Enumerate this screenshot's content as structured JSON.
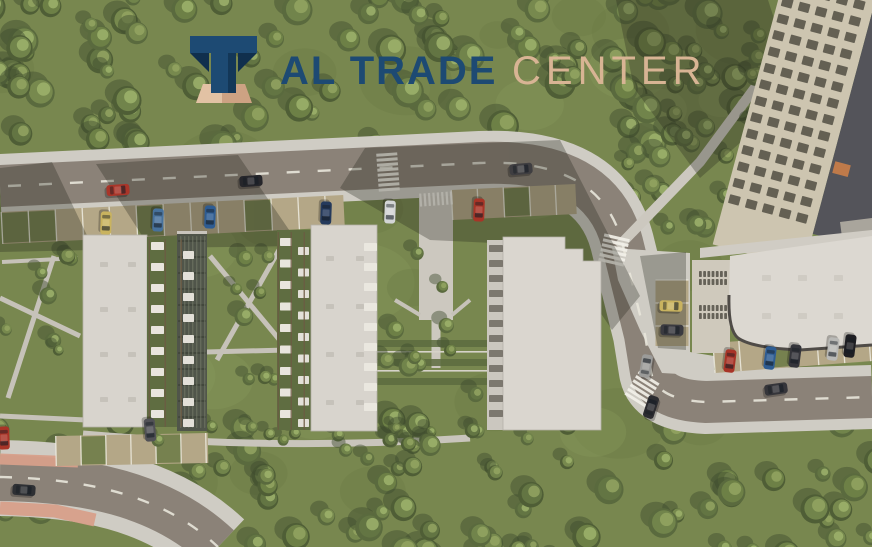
{
  "meta": {
    "width": 872,
    "height": 547,
    "kind": "aerial-masterplan-render"
  },
  "logo": {
    "icon": "arch-monument-icon",
    "title_primary": "AL TRADE",
    "title_secondary": "CENTER",
    "colors": {
      "primary": "#1d4a73",
      "primary_dark": "#102f4d",
      "secondary": "#d8b494",
      "base_light": "#e2c2a4",
      "base_mid": "#cda283"
    }
  },
  "scene": {
    "palette": {
      "grass": "#78874f",
      "grass_light": "#8a9a5c",
      "grass_dark": "#697844",
      "tree_dark": [
        "#4f5e36",
        "#5a6a3e"
      ],
      "tree_main": [
        "#6d8046",
        "#77894e",
        "#637543",
        "#71844b"
      ],
      "tree_light": [
        "#93a562",
        "#9db36c"
      ],
      "tree_shadow": "#3f4c2e",
      "road": "#8b8278",
      "sidewalk": "#cfccc4",
      "stall": "#b4a787",
      "stall_green": "#76814f",
      "stall_line": "#efede2",
      "marking": "#e8e5da",
      "crosswalk": "#f2f0e8",
      "roof": "#d8d4cd",
      "roof_big": "#dcd8d1",
      "shadow": "#23251c",
      "salmon": "#d79f8a"
    },
    "car_style": {
      "length": 23,
      "width": 11
    },
    "cars": [
      {
        "name": "car-red-main-road",
        "x": 118,
        "y": 190,
        "angle": -4,
        "color": "#a93529"
      },
      {
        "name": "car-black-main-road",
        "x": 251,
        "y": 181,
        "angle": -4,
        "color": "#26262b"
      },
      {
        "name": "car-gray-main-road",
        "x": 521,
        "y": 169,
        "angle": -5,
        "color": "#3f3e41"
      },
      {
        "name": "car-silver-east-road",
        "x": 646,
        "y": 366,
        "angle": -80,
        "color": "#9b9b99"
      },
      {
        "name": "car-dark-east-road",
        "x": 651,
        "y": 407,
        "angle": -72,
        "color": "#2c2c30"
      },
      {
        "name": "car-dark-se-road",
        "x": 776,
        "y": 389,
        "angle": -8,
        "color": "#35353a"
      },
      {
        "name": "car-dark-sw-road",
        "x": 24,
        "y": 490,
        "angle": 4,
        "color": "#2e3034"
      },
      {
        "name": "car-parked-yellow-1",
        "x": 106,
        "y": 223,
        "angle": 92,
        "color": "#c9b35f"
      },
      {
        "name": "car-parked-blue-1",
        "x": 158,
        "y": 220,
        "angle": 92,
        "color": "#47719c"
      },
      {
        "name": "car-parked-blue-2",
        "x": 210,
        "y": 217,
        "angle": 92,
        "color": "#2e5c92"
      },
      {
        "name": "car-parked-navy",
        "x": 326,
        "y": 213,
        "angle": 92,
        "color": "#253a5c"
      },
      {
        "name": "car-parked-white",
        "x": 390,
        "y": 212,
        "angle": 92,
        "color": "#d3d5d6"
      },
      {
        "name": "car-parked-red-1",
        "x": 479,
        "y": 210,
        "angle": 92,
        "color": "#a83427"
      },
      {
        "name": "car-parked-yellow-2",
        "x": 671,
        "y": 306,
        "angle": 2,
        "color": "#c9b35f"
      },
      {
        "name": "car-parked-dark-1",
        "x": 672,
        "y": 330,
        "angle": 2,
        "color": "#3a3a40"
      },
      {
        "name": "car-parked-red-2",
        "x": 730,
        "y": 361,
        "angle": 97,
        "color": "#a83427"
      },
      {
        "name": "car-parked-blue-3",
        "x": 770,
        "y": 358,
        "angle": 97,
        "color": "#2e5c92"
      },
      {
        "name": "car-parked-dark-2",
        "x": 795,
        "y": 356,
        "angle": 97,
        "color": "#35353b"
      },
      {
        "name": "car-parked-white-2",
        "x": 833,
        "y": 349,
        "angle": 97,
        "color": "#b9b9b6"
      },
      {
        "name": "car-parked-black",
        "x": 850,
        "y": 346,
        "angle": 97,
        "color": "#1f1f23"
      },
      {
        "name": "car-parked-gray-sw",
        "x": 150,
        "y": 430,
        "angle": 85,
        "color": "#515156"
      },
      {
        "name": "car-parked-red-edge",
        "x": 4,
        "y": 438,
        "angle": 88,
        "color": "#a83427"
      }
    ],
    "stall_strips": [
      {
        "name": "parking-main-west",
        "x1": 2,
        "y1": 228,
        "x2": 344,
        "y2": 211,
        "width": 32,
        "step": 27,
        "olive": [
          0,
          1,
          5,
          9
        ]
      },
      {
        "name": "parking-main-east",
        "x1": 452,
        "y1": 205,
        "x2": 576,
        "y2": 199,
        "width": 30,
        "step": 26,
        "olive": [
          2
        ]
      },
      {
        "name": "parking-se",
        "x1": 714,
        "y1": 358,
        "x2": 872,
        "y2": 346,
        "width": 30,
        "step": 26,
        "olive": [
          2
        ]
      },
      {
        "name": "parking-sw",
        "x1": 56,
        "y1": 451,
        "x2": 208,
        "y2": 448,
        "width": 30,
        "step": 25,
        "olive": [
          1,
          4
        ]
      },
      {
        "name": "parking-east-road",
        "x1": 672,
        "y1": 280,
        "x2": 672,
        "y2": 346,
        "width": 33,
        "step": 23,
        "olive": []
      }
    ],
    "crosswalks": [
      {
        "name": "crosswalk-main-road",
        "cx": 388,
        "cy": 172,
        "rotate": -4,
        "orient": "v",
        "n": 8,
        "gap": 5,
        "len": 21,
        "w": 3
      },
      {
        "name": "crosswalk-promenade",
        "cx": 436,
        "cy": 199,
        "rotate": -4,
        "orient": "h",
        "n": 8,
        "gap": 4.4,
        "len": 13,
        "w": 2.2
      },
      {
        "name": "crosswalk-east-upper",
        "cx": 614,
        "cy": 250,
        "rotate": 13,
        "orient": "v",
        "n": 6,
        "gap": 5,
        "len": 26,
        "w": 3
      },
      {
        "name": "crosswalk-east-lower",
        "cx": 642,
        "cy": 389,
        "rotate": 32,
        "orient": "v",
        "n": 6,
        "gap": 5,
        "len": 24,
        "w": 3
      }
    ],
    "vegetation": [
      {
        "name": "ambient-patches",
        "phase": 0,
        "x": 0,
        "y": 0,
        "w": 872,
        "h": 547,
        "count": 42,
        "rmin": 18,
        "rmax": 55,
        "style": "patch"
      },
      {
        "name": "north-forest",
        "phase": 1,
        "x": -10,
        "y": -12,
        "w": 892,
        "h": 158,
        "count": 100,
        "rmin": 7,
        "rmax": 16,
        "style": "tree"
      },
      {
        "name": "east-grove",
        "phase": 1,
        "x": 598,
        "y": 128,
        "w": 274,
        "h": 130,
        "count": 20,
        "rmin": 6,
        "rmax": 12,
        "style": "tree"
      },
      {
        "name": "south-forest",
        "phase": 1,
        "x": -10,
        "y": 420,
        "w": 892,
        "h": 140,
        "count": 75,
        "rmin": 7,
        "rmax": 15,
        "style": "tree"
      },
      {
        "name": "left-courtyard-trees",
        "phase": 2,
        "x": 5,
        "y": 255,
        "w": 70,
        "h": 160,
        "count": 7,
        "rmin": 5,
        "rmax": 9,
        "style": "tree"
      },
      {
        "name": "mid-courtyard-trees",
        "phase": 2,
        "x": 208,
        "y": 248,
        "w": 70,
        "h": 135,
        "count": 8,
        "rmin": 5,
        "rmax": 10,
        "style": "tree"
      },
      {
        "name": "promenade-trees",
        "phase": 2,
        "x": 382,
        "y": 222,
        "w": 100,
        "h": 175,
        "count": 10,
        "rmin": 5,
        "rmax": 10,
        "style": "tree"
      },
      {
        "name": "east-lawn-trees",
        "phase": 2,
        "x": 642,
        "y": 35,
        "w": 128,
        "h": 190,
        "count": 12,
        "rmin": 5,
        "rmax": 10,
        "style": "tree"
      },
      {
        "name": "hedgerow-trees",
        "phase": 2,
        "x": 85,
        "y": 426,
        "w": 400,
        "h": 20,
        "count": 14,
        "rmin": 5,
        "rmax": 8,
        "style": "tree"
      },
      {
        "name": "south-lawn-trees",
        "phase": 2,
        "x": 300,
        "y": 432,
        "w": 290,
        "h": 55,
        "count": 9,
        "rmin": 6,
        "rmax": 11,
        "style": "tree"
      }
    ],
    "repeats": [
      {
        "name": "tower-windows",
        "transform": "rotate(15 800 100)",
        "x": 757,
        "y": -12,
        "nx": 5,
        "ny": 14,
        "dx": 17.5,
        "dy": 17,
        "w": 11,
        "h": 9,
        "fill": "#4a463c",
        "opacity": 0.8
      },
      {
        "name": "garage-wing-louvers-1",
        "x": 699,
        "y": 271,
        "nx": 7,
        "ny": 2,
        "dx": 4.2,
        "dy": 8,
        "w": 2.8,
        "h": 6,
        "fill": "#5a564c",
        "opacity": 0.9
      },
      {
        "name": "garage-wing-louvers-2",
        "x": 699,
        "y": 305,
        "nx": 7,
        "ny": 2,
        "dx": 4.2,
        "dy": 8,
        "w": 2.8,
        "h": 6,
        "fill": "#5a564c",
        "opacity": 0.9
      },
      {
        "name": "building-d-facade-bands",
        "x": 489,
        "y": 245,
        "nx": 1,
        "ny": 12,
        "dx": 0,
        "dy": 15,
        "w": 14,
        "h": 7,
        "fill": "#6e6a60",
        "opacity": 0.85
      },
      {
        "name": "building-b-floor-lines",
        "x": 178,
        "y": 240,
        "nx": 1,
        "ny": 12,
        "dx": 0,
        "dy": 16,
        "w": 28,
        "h": 2,
        "fill": "#3c4136",
        "opacity": 0.7
      },
      {
        "name": "building-b-mullions",
        "x": 180,
        "y": 236,
        "nx": 7,
        "ny": 1,
        "dx": 4,
        "dy": 0,
        "w": 1.4,
        "h": 192,
        "fill": "#767b6a",
        "opacity": 0.55
      },
      {
        "name": "terrace-boxes-a1",
        "x": 151,
        "y": 242,
        "nx": 1,
        "ny": 9,
        "dx": 0,
        "dy": 21,
        "w": 13,
        "h": 8,
        "fill": "#e8e5dd",
        "opacity": 1
      },
      {
        "name": "terrace-boxes-a2",
        "x": 183,
        "y": 251,
        "nx": 1,
        "ny": 9,
        "dx": 0,
        "dy": 21,
        "w": 11,
        "h": 8,
        "fill": "#e3e0d8",
        "opacity": 1
      },
      {
        "name": "terrace-dividers-a",
        "x": 148.5,
        "y": 239,
        "nx": 3,
        "ny": 1,
        "dx": 16,
        "dy": 0,
        "w": 1.5,
        "h": 188,
        "fill": "#6b5a42",
        "opacity": 0.8
      },
      {
        "name": "terrace-boxes-c1",
        "x": 280,
        "y": 238,
        "nx": 1,
        "ny": 9,
        "dx": 0,
        "dy": 21.5,
        "w": 12,
        "h": 8,
        "fill": "#e8e5dd",
        "opacity": 1
      },
      {
        "name": "terrace-boxes-c2",
        "x": 298,
        "y": 247,
        "nx": 1,
        "ny": 9,
        "dx": 0,
        "dy": 21.5,
        "w": 11,
        "h": 8,
        "fill": "#e3e0d8",
        "opacity": 1
      },
      {
        "name": "terrace-dividers-c",
        "x": 277.5,
        "y": 232,
        "nx": 3,
        "ny": 1,
        "dx": 13,
        "dy": 0,
        "w": 1.5,
        "h": 198,
        "fill": "#6b5a42",
        "opacity": 0.8
      },
      {
        "name": "balcony-boxes-c-east",
        "x": 364,
        "y": 243,
        "nx": 1,
        "ny": 9,
        "dx": 0,
        "dy": 20,
        "w": 13,
        "h": 8,
        "fill": "#eae7df",
        "opacity": 1
      },
      {
        "name": "roof-vents-a",
        "x": 100,
        "y": 262,
        "nx": 2,
        "ny": 4,
        "dx": 28,
        "dy": 45,
        "w": 8,
        "h": 5,
        "fill": "#c6c2ba",
        "opacity": 1
      },
      {
        "name": "roof-vents-c",
        "x": 326,
        "y": 256,
        "nx": 2,
        "ny": 4,
        "dx": 30,
        "dy": 48,
        "w": 8,
        "h": 5,
        "fill": "#c6c2ba",
        "opacity": 1
      },
      {
        "name": "roof-vents-complex",
        "x": 762,
        "y": 275,
        "nx": 3,
        "ny": 2,
        "dx": 36,
        "dy": 38,
        "w": 9,
        "h": 6,
        "fill": "#cfcbc3",
        "opacity": 1
      }
    ]
  }
}
